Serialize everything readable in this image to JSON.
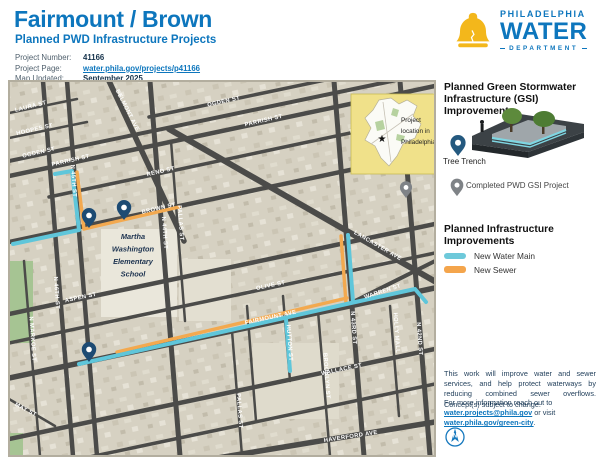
{
  "header": {
    "title": "Fairmount / Brown",
    "subtitle": "Planned PWD Infrastructure Projects",
    "meta": [
      {
        "label": "Project Number:",
        "value": "41166",
        "link": false
      },
      {
        "label": "Project Page:",
        "value": "water.phila.gov/projects/p41166",
        "link": true
      },
      {
        "label": "Map Updated:",
        "value": "September 2025",
        "link": false
      }
    ]
  },
  "logo": {
    "city": "PHILADELPHIA",
    "water": "WATER",
    "dept": "DEPARTMENT"
  },
  "sidebar": {
    "gsi_heading": "Planned Green Stormwater Infrastructure (GSI) Improvements",
    "tree_trench_label": "Tree Trench",
    "completed_label": "Completed PWD GSI Project",
    "infra_heading": "Planned Infrastructure Improvements",
    "legend": [
      {
        "label": "New Water Main",
        "color": "#6ec9da"
      },
      {
        "label": "New Sewer",
        "color": "#f4a54c"
      }
    ],
    "note1": "This work will improve water and sewer services, and help protect waterways by reducing combined sewer overflows. Concept(s) subject to change.",
    "note2_prefix": "For more information reach out to ",
    "note2_link1": "water.projects@phila.gov",
    "note2_mid": " or visit ",
    "note2_link2": "water.phila.gov/green-city",
    "note2_suffix": ".",
    "compass_letter": "N"
  },
  "map": {
    "colors": {
      "bg": "#d6d1c2",
      "street": "#4b4b49",
      "label": "#ffffff",
      "water": "#5fc6da",
      "sewer": "#f3a94f",
      "pin": "#1d4b73",
      "pin_done": "#7f8387",
      "park": "#a6c493",
      "school_text": "#1d3350",
      "inset_bg": "#f0e18a"
    },
    "streets": [
      [
        0,
        32,
        68,
        18,
        2.5
      ],
      [
        0,
        57,
        78,
        41,
        2.5
      ],
      [
        0,
        80,
        426,
        -9,
        4
      ],
      [
        140,
        36,
        426,
        -24,
        3.5
      ],
      [
        0,
        95,
        426,
        5,
        4.5
      ],
      [
        40,
        116,
        426,
        34,
        3.5
      ],
      [
        0,
        161,
        426,
        71,
        4.5
      ],
      [
        0,
        233,
        426,
        143,
        4.5
      ],
      [
        0,
        262,
        426,
        172,
        3.5
      ],
      [
        0,
        297,
        426,
        207,
        5.5
      ],
      [
        0,
        358,
        426,
        268,
        4.5
      ],
      [
        0,
        393,
        426,
        303,
        3.5
      ],
      [
        130,
        390,
        426,
        341,
        5.5
      ],
      [
        0,
        318,
        46,
        345,
        2.5
      ],
      [
        34,
        0,
        64,
        375,
        4.5
      ],
      [
        58,
        0,
        88,
        375,
        4.5
      ],
      [
        141,
        0,
        171,
        375,
        5
      ],
      [
        15,
        180,
        31,
        375,
        2.5
      ],
      [
        162,
        60,
        176,
        240,
        2.5
      ],
      [
        223,
        250,
        233,
        375,
        2.5
      ],
      [
        238,
        225,
        247,
        340,
        2.5
      ],
      [
        274,
        215,
        281,
        300,
        2.5
      ],
      [
        325,
        0,
        355,
        375,
        5
      ],
      [
        309,
        230,
        321,
        375,
        2.5
      ],
      [
        381,
        225,
        390,
        335,
        2.5
      ],
      [
        391,
        0,
        421,
        375,
        5
      ],
      [
        100,
        0,
        175,
        160,
        5.5
      ],
      [
        160,
        48,
        434,
        205,
        6
      ],
      [
        330,
        228,
        426,
        180,
        4
      ]
    ],
    "labels": [
      [
        "LAURA ST",
        22,
        27,
        -14
      ],
      [
        "HOOPES ST",
        26,
        50,
        -13
      ],
      [
        "OGDEN ST",
        30,
        73,
        -13
      ],
      [
        "OGDEN ST",
        215,
        22,
        -13
      ],
      [
        "PARRISH ST",
        62,
        81,
        -13
      ],
      [
        "PARRISH ST",
        255,
        41,
        -13
      ],
      [
        "RENO ST",
        152,
        92,
        -13
      ],
      [
        "RENO ST",
        355,
        49,
        -13
      ],
      [
        "BROWN ST",
        150,
        129,
        -13
      ],
      [
        "BELMONT AVE",
        117,
        30,
        63
      ],
      [
        "LANCASTER AVE",
        368,
        166,
        30
      ],
      [
        "WARREN ST",
        374,
        212,
        -18
      ],
      [
        "FAIRMOUNT AVE",
        262,
        238,
        -12
      ],
      [
        "ASPEN ST",
        72,
        218,
        -12
      ],
      [
        "OLIVE ST",
        262,
        206,
        -12
      ],
      [
        "WALLACE ST",
        333,
        290,
        -12
      ],
      [
        "HAVERFORD AVE",
        342,
        357,
        -9
      ],
      [
        "HUTTON ST",
        279,
        262,
        86
      ],
      [
        "MAY ST",
        16,
        330,
        28
      ],
      [
        "N MARKOE ST",
        22,
        258,
        86
      ],
      [
        "N 46TH ST",
        46,
        212,
        86
      ],
      [
        "N 45TH ST",
        63,
        100,
        86
      ],
      [
        "N 44TH ST",
        154,
        152,
        86
      ],
      [
        "PALLAS ST",
        170,
        142,
        86
      ],
      [
        "PALLAS ST",
        229,
        330,
        86
      ],
      [
        "N 43RD ST",
        343,
        247,
        86
      ],
      [
        "BROOKLYN ST",
        316,
        295,
        86
      ],
      [
        "HOLLY MALL",
        386,
        252,
        86
      ],
      [
        "N 42ND ST",
        409,
        258,
        86
      ]
    ],
    "water": [
      [
        [
          46,
          93
        ],
        [
          63,
          90
        ],
        [
          70,
          149
        ],
        [
          4,
          163
        ]
      ],
      [
        [
          70,
          283
        ],
        [
          342,
          222
        ],
        [
          406,
          208
        ],
        [
          417,
          221
        ]
      ],
      [
        [
          277,
          238
        ],
        [
          281,
          290
        ]
      ],
      [
        [
          339,
          154
        ],
        [
          344,
          221
        ]
      ]
    ],
    "sewer": [
      [
        [
          68,
          91
        ],
        [
          75,
          148
        ]
      ],
      [
        [
          75,
          148
        ],
        [
          170,
          126
        ]
      ],
      [
        [
          108,
          271
        ],
        [
          338,
          217
        ]
      ],
      [
        [
          332,
          155
        ],
        [
          337,
          222
        ]
      ]
    ],
    "pins": {
      "tree": [
        [
          80,
          147
        ],
        [
          115,
          139
        ],
        [
          80,
          281
        ]
      ],
      "done": [
        [
          397,
          117
        ]
      ]
    },
    "parks": [
      [
        0,
        180,
        24,
        82
      ],
      [
        0,
        352,
        14,
        23
      ]
    ],
    "blocks": [
      [
        92,
        148,
        76,
        88,
        "#eae7db"
      ],
      [
        170,
        178,
        52,
        62,
        "#e3dfd1"
      ],
      [
        244,
        262,
        86,
        76,
        "#dfdbcc"
      ]
    ],
    "school": {
      "lines": [
        "Martha",
        "Washington",
        "Elementary",
        "School"
      ],
      "cx": 124,
      "y0": 158,
      "lh": 12.5
    },
    "inset": {
      "x": 342,
      "y": 13,
      "w": 84,
      "h": 80,
      "label_lines": [
        "Project",
        "location in",
        "Philadelphia"
      ]
    }
  }
}
